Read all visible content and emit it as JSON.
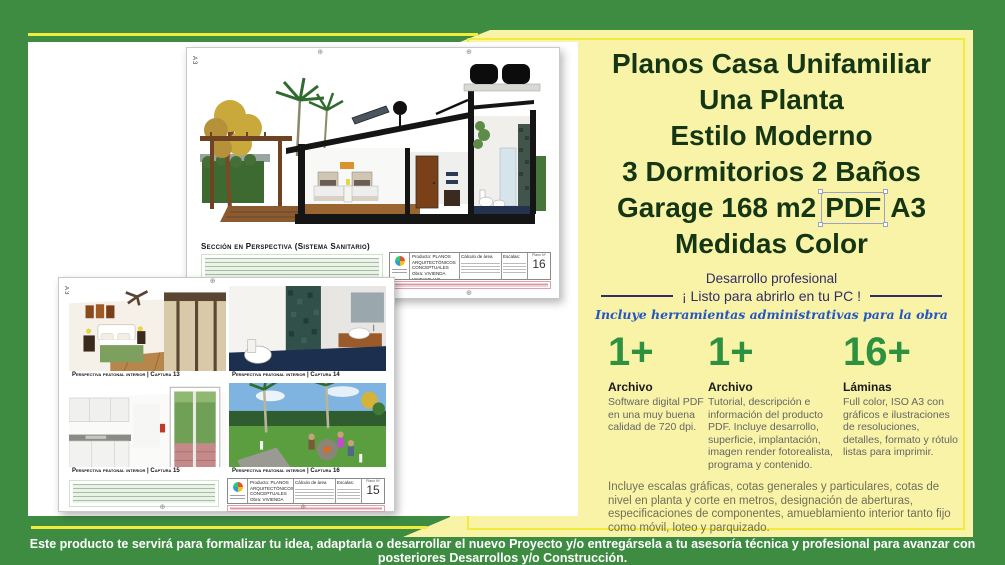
{
  "colors": {
    "background_green": "#3e8c42",
    "panel_pale_yellow": "#f8f3a6",
    "accent_yellow": "#f2eb3d",
    "title_dark_green": "#153615",
    "tagline_navy": "#332d66",
    "script_blue": "#2456c8",
    "count_green": "#2e9140"
  },
  "panel": {
    "title": {
      "l1": "Planos Casa Unifamiliar",
      "l2": "Una Planta",
      "l3": "Estilo Moderno",
      "l4": "3 Dormitorios 2 Baños",
      "l5a": "Garage 168 m2",
      "l5b": "PDF",
      "l5c": "A3",
      "l6": "Medidas Color"
    },
    "tagline1": "Desarrollo profesional",
    "tagline2": "¡ Listo para abrirlo en tu PC !",
    "tagline3": "Incluye herramientas administrativas para la obra",
    "features": [
      {
        "count": "1+",
        "heading": "Archivo",
        "text": "Software digital PDF en una muy buena calidad de 720 dpi."
      },
      {
        "count": "1+",
        "heading": "Archivo",
        "text": "Tutorial, descripción e información del producto PDF. Incluye desarrollo, superficie, implantación, imagen render fotorealista, programa y contenido."
      },
      {
        "count": "16+",
        "heading": "Láminas",
        "text": "Full color, ISO A3 con gráficos e ilustraciones de resoluciones, detalles, formato y rótulo listas para imprimir."
      }
    ],
    "details": "Incluye escalas gráficas, cotas generales y particulares, cotas de nivel en planta y corte en metros, designación de aberturas, especificaciones de componentes, amueblamiento interior tanto fijo como móvil, loteo y parquizado."
  },
  "footer": {
    "text": "Este producto te servirá para formalizar tu idea, adaptarla o desarrollar el nuevo Proyecto y/o entregársela a tu asesoría técnica y profesional para avanzar con posteriores Desarrollos y/o Construcción."
  },
  "sheets": {
    "block": {
      "line1": "Producto: PLANOS ARQUITECTÓNICOS CONCEPTUALES",
      "line2": "Obra: VIVIENDA UNIFAMILIAR",
      "line3": "bº MURALLA DE LA ESPERANZA",
      "col_calculo": "Cálculo de área",
      "col_escalas": "Escalas:",
      "plano_label": "Plano Nº"
    },
    "section": {
      "format": "A3",
      "caption": "Sección en Perspectiva (Sistema Sanitario)",
      "number": "16"
    },
    "renders": {
      "format": "A3",
      "number": "15",
      "captions": [
        "Perspectiva peatonal interior | Captura 13",
        "Perspectiva peatonal interior | Captura 14",
        "Perspectiva peatonal interior | Captura 15",
        "Perspectiva peatonal interior | Captura 16"
      ]
    }
  }
}
